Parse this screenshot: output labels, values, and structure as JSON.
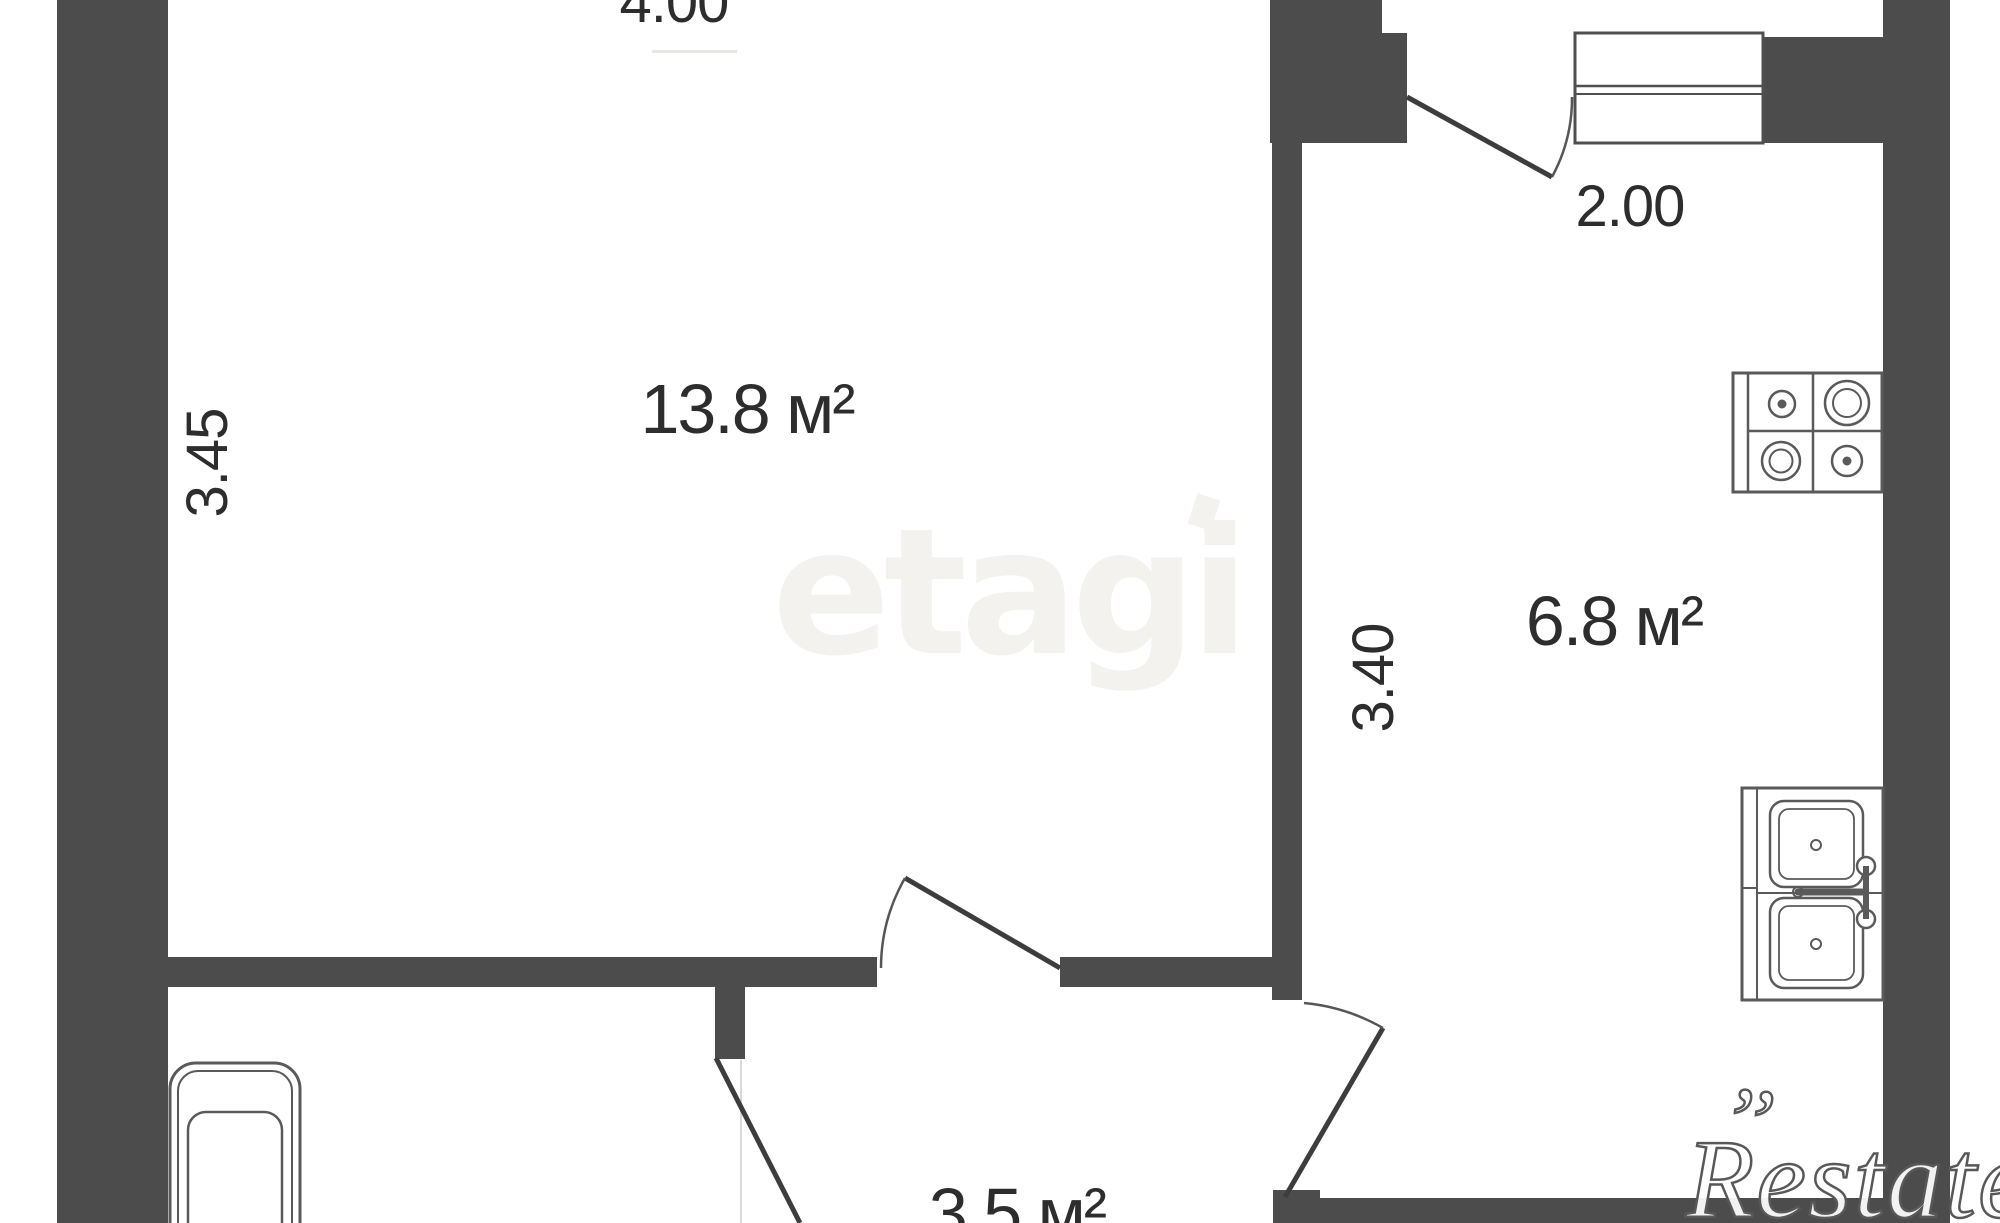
{
  "floorplan": {
    "type": "apartment-floor-plan",
    "rooms": [
      {
        "id": "living-room",
        "area_label": "13.8 м²",
        "width_label": "4.00",
        "depth_label": "3.45"
      },
      {
        "id": "kitchen",
        "area_label": "6.8 м²",
        "width_label": "2.00",
        "depth_label": "3.40"
      },
      {
        "id": "hallway",
        "area_label": "3.5 м²"
      }
    ],
    "fixtures": [
      "bathtub-icon",
      "stove-icon",
      "sink-icon",
      "window-icon",
      "door-swing-icon"
    ],
    "watermarks": {
      "center": "etagi",
      "brand": "Restate",
      "brand_flourish": "’’"
    },
    "colors": {
      "wall": "#4c4c4c",
      "door_line": "#3d3d3d",
      "arc_line": "#565656",
      "fixture_line": "#5a5a5a",
      "label_text": "#2d2d2d",
      "watermark_center": "#f4f2ef",
      "watermark_brand_stroke": "#585858"
    }
  }
}
